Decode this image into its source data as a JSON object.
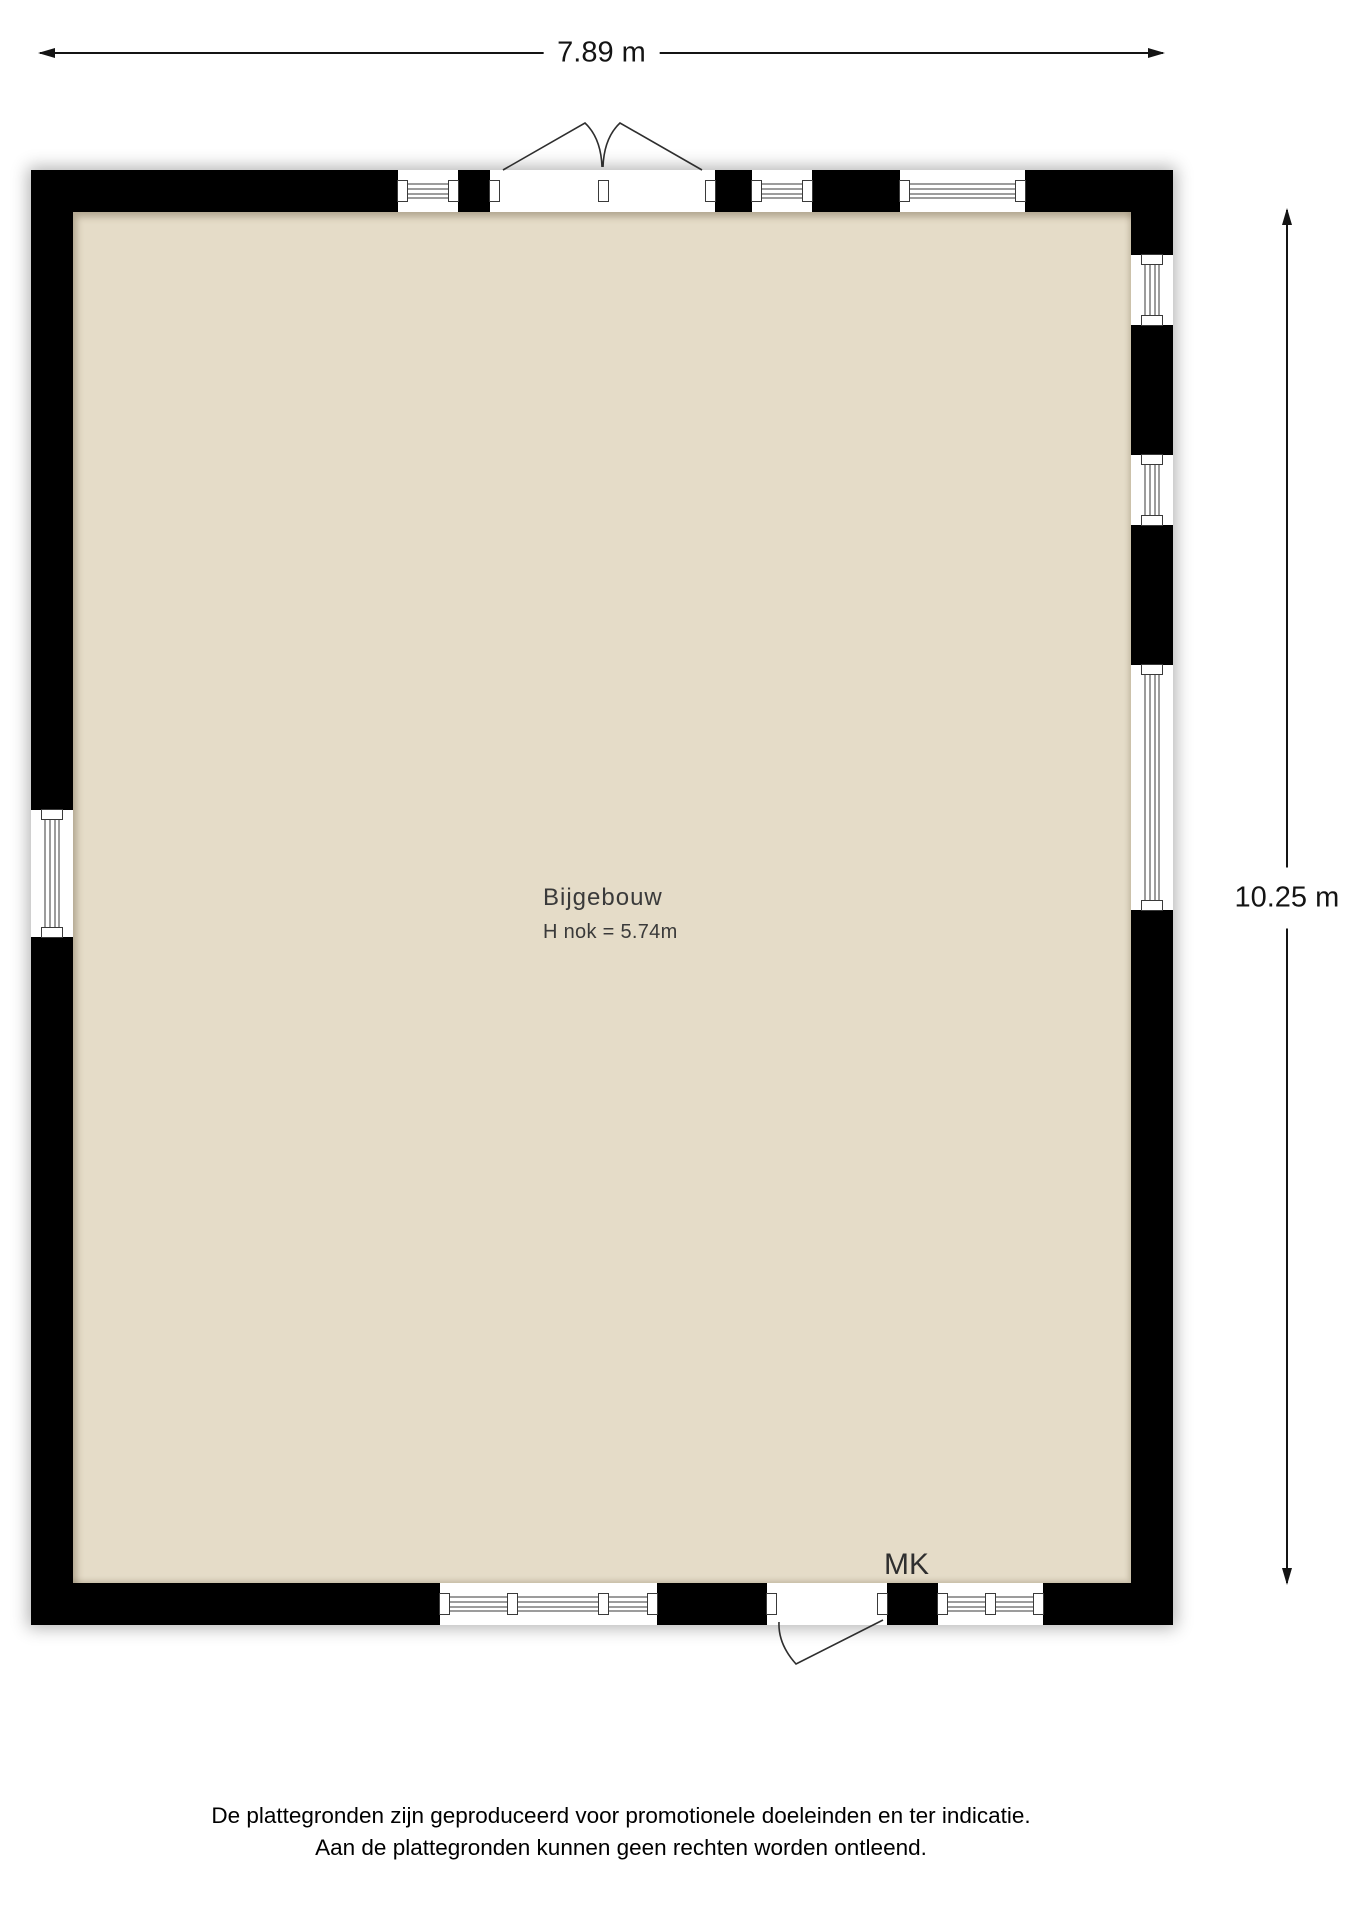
{
  "colors": {
    "background": "#ffffff",
    "wall": "#000000",
    "floor": "#e5dcc8",
    "dimension_line": "#141414",
    "label_text": "#3a3a3a"
  },
  "dimensions": {
    "width_label": "7.89 m",
    "height_label": "10.25 m"
  },
  "room": {
    "name": "Bijgebouw",
    "ridge_height_note": "H nok = 5.74m",
    "meter_cupboard_label": "MK"
  },
  "disclaimer": {
    "line1": "De plattegronden zijn geproduceerd voor promotionele doeleinden en ter indicatie.",
    "line2": "Aan de plattegronden kunnen geen rechten worden ontleend."
  },
  "plan": {
    "outer": {
      "left": 31,
      "top": 170,
      "right": 1173,
      "bottom": 1625
    },
    "wall_thickness": 42,
    "windows": [
      {
        "wall": "top",
        "start": 398,
        "len": 60,
        "mullions": []
      },
      {
        "wall": "top",
        "start": 752,
        "len": 60,
        "mullions": []
      },
      {
        "wall": "top",
        "start": 900,
        "len": 125,
        "mullions": []
      },
      {
        "wall": "right",
        "start": 255,
        "len": 70,
        "mullions": []
      },
      {
        "wall": "right",
        "start": 455,
        "len": 70,
        "mullions": []
      },
      {
        "wall": "right",
        "start": 665,
        "len": 245,
        "mullions": []
      },
      {
        "wall": "left",
        "start": 810,
        "len": 127,
        "mullions": []
      },
      {
        "wall": "bottom",
        "start": 440,
        "len": 217,
        "mullions": [
          72,
          163
        ]
      },
      {
        "wall": "bottom",
        "start": 938,
        "len": 105,
        "mullions": [
          52
        ]
      }
    ],
    "doors": [
      {
        "type": "double",
        "wall": "top",
        "start": 490,
        "end": 715
      },
      {
        "type": "single",
        "wall": "bottom",
        "start": 767,
        "end": 887
      }
    ]
  }
}
